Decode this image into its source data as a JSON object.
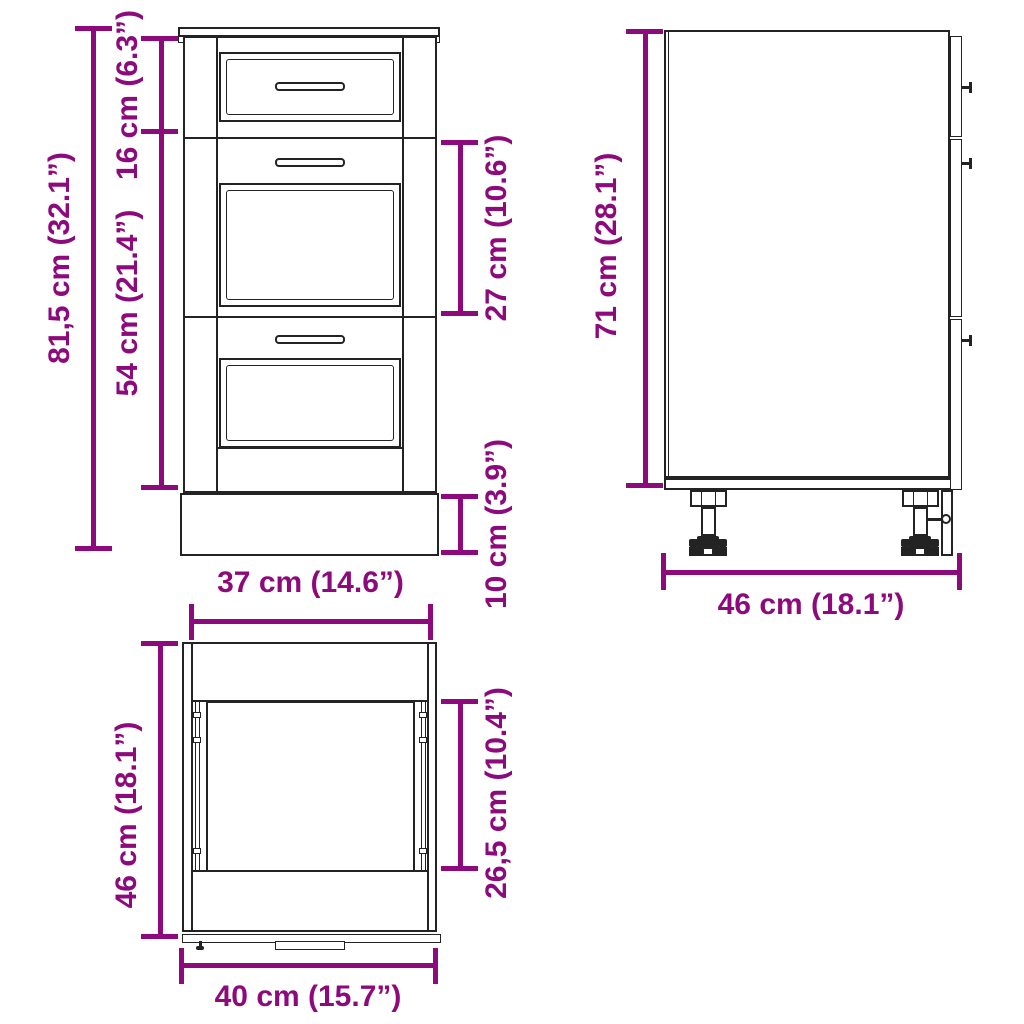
{
  "colors": {
    "accent": "#8d0a7c",
    "ink": "#232323",
    "background": "#ffffff"
  },
  "dims": {
    "front": {
      "total_height": "81,5 cm (32.1”)",
      "top_drawer": "16 cm (6.3”)",
      "lower_drawers": "54 cm (21.4”)",
      "middle_drawer": "27 cm (10.6”)",
      "plinth": "10 cm (3.9”)",
      "width": "37 cm (14.6”)"
    },
    "side": {
      "height": "71 cm (28.1”)",
      "depth": "46 cm (18.1”)"
    },
    "top": {
      "depth": "46 cm (18.1”)",
      "inner_depth": "26,5 cm (10.4”)",
      "width": "40 cm (15.7”)"
    }
  }
}
